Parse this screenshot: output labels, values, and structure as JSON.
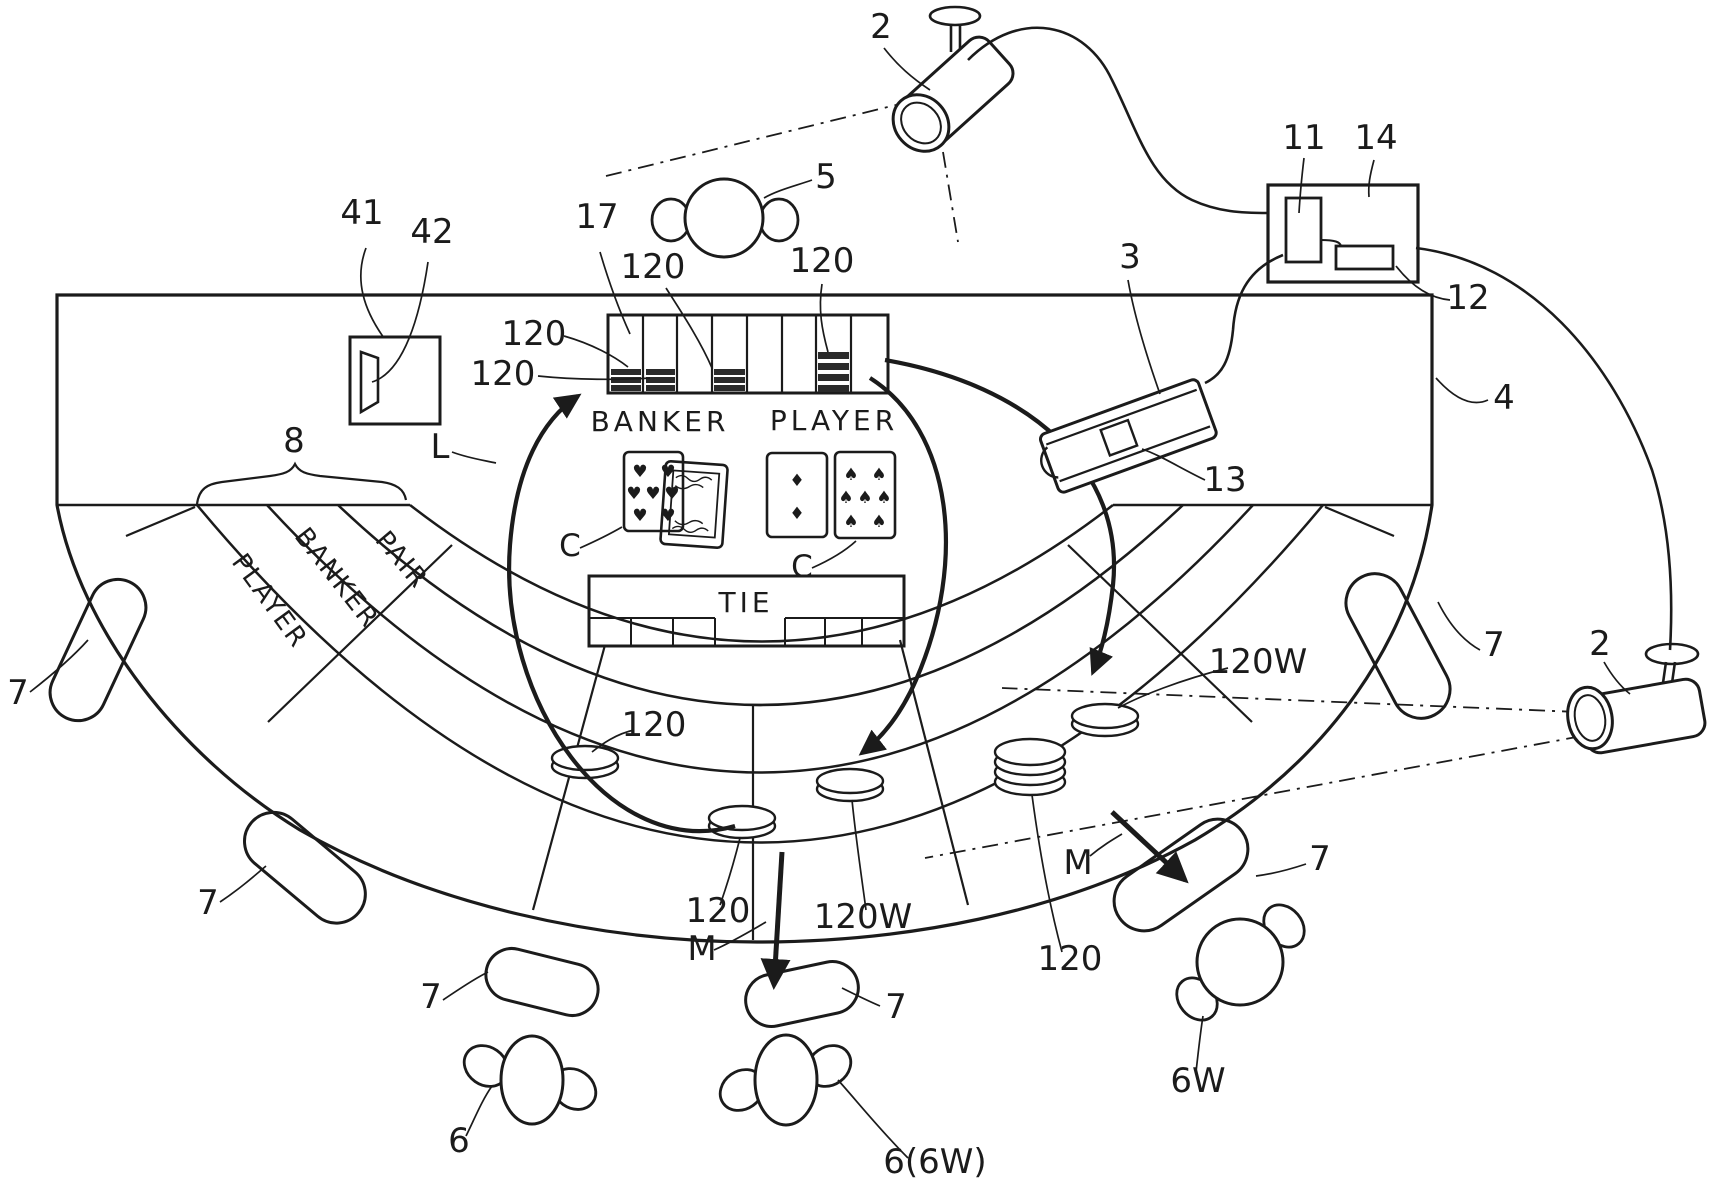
{
  "figure_labels": {
    "camera": "2",
    "dealer_person": "5",
    "display_device": "41",
    "display_slot": "42",
    "chip_tray": "17",
    "chip": "120",
    "chip_winning": "120W",
    "card_shoe": "3",
    "shoe_reader": "13",
    "game_table": "4",
    "bet_areas_group": "8",
    "layout": "L",
    "control_unit": "11",
    "control_box": "14",
    "memory_unit": "12",
    "chip_move": "M",
    "chair": "7",
    "player_seated": "6",
    "player_walking": "6W",
    "player_seated_alt": "6(6W)",
    "card": "C"
  },
  "table_text": {
    "banker_area": "BANKER",
    "player_area": "PLAYER",
    "tie_area": "TIE",
    "band_player": "PLAYER",
    "band_banker": "BANKER",
    "band_pair": "PAIR"
  },
  "cards": {
    "banker": [
      "7 of hearts",
      "face card"
    ],
    "player": [
      "2 of diamonds",
      "7 of spades"
    ]
  },
  "suits": {
    "heart": "♥",
    "diamond": "♦",
    "spade": "♠"
  },
  "colors": {
    "ink": "#1b1b1b",
    "paper": "#ffffff"
  }
}
